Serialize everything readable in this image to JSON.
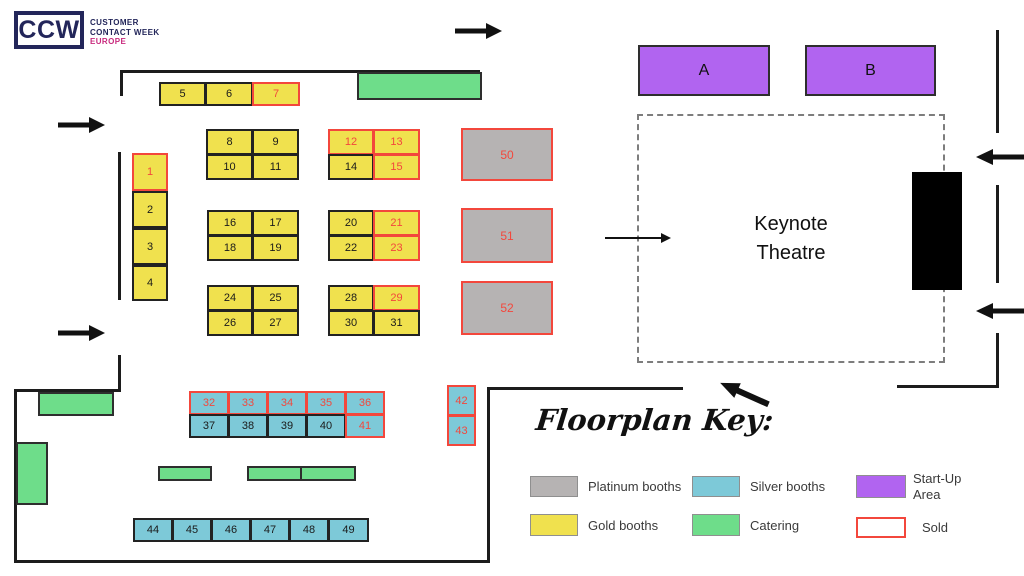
{
  "logo": {
    "mark": "CCW",
    "line1": "CUSTOMER",
    "line2": "CONTACT WEEK",
    "line3": "EUROPE"
  },
  "keynote_theatre": {
    "line1": "Keynote",
    "line2": "Theatre"
  },
  "startup_areas": {
    "a": "A",
    "b": "B"
  },
  "booths": [
    {
      "id": "1",
      "type": "gold",
      "x": 132,
      "y": 153,
      "w": 36,
      "h": 38,
      "sold": true
    },
    {
      "id": "2",
      "type": "gold",
      "x": 132,
      "y": 191,
      "w": 36,
      "h": 37,
      "sold": false
    },
    {
      "id": "3",
      "type": "gold",
      "x": 132,
      "y": 228,
      "w": 36,
      "h": 37,
      "sold": false
    },
    {
      "id": "4",
      "type": "gold",
      "x": 132,
      "y": 265,
      "w": 36,
      "h": 36,
      "sold": false
    },
    {
      "id": "5",
      "type": "gold",
      "x": 159,
      "y": 82,
      "w": 47,
      "h": 24,
      "sold": false
    },
    {
      "id": "6",
      "type": "gold",
      "x": 205,
      "y": 82,
      "w": 48,
      "h": 24,
      "sold": false
    },
    {
      "id": "7",
      "type": "gold",
      "x": 252,
      "y": 82,
      "w": 48,
      "h": 24,
      "sold": true
    },
    {
      "id": "8",
      "type": "gold",
      "x": 206,
      "y": 129,
      "w": 47,
      "h": 26,
      "sold": false
    },
    {
      "id": "9",
      "type": "gold",
      "x": 252,
      "y": 129,
      "w": 47,
      "h": 26,
      "sold": false
    },
    {
      "id": "10",
      "type": "gold",
      "x": 206,
      "y": 154,
      "w": 47,
      "h": 26,
      "sold": false
    },
    {
      "id": "11",
      "type": "gold",
      "x": 252,
      "y": 154,
      "w": 47,
      "h": 26,
      "sold": false
    },
    {
      "id": "12",
      "type": "gold",
      "x": 328,
      "y": 129,
      "w": 46,
      "h": 26,
      "sold": true
    },
    {
      "id": "13",
      "type": "gold",
      "x": 373,
      "y": 129,
      "w": 47,
      "h": 26,
      "sold": true
    },
    {
      "id": "14",
      "type": "gold",
      "x": 328,
      "y": 154,
      "w": 46,
      "h": 26,
      "sold": false
    },
    {
      "id": "15",
      "type": "gold",
      "x": 373,
      "y": 154,
      "w": 47,
      "h": 26,
      "sold": true
    },
    {
      "id": "16",
      "type": "gold",
      "x": 207,
      "y": 210,
      "w": 46,
      "h": 26,
      "sold": false
    },
    {
      "id": "17",
      "type": "gold",
      "x": 252,
      "y": 210,
      "w": 47,
      "h": 26,
      "sold": false
    },
    {
      "id": "18",
      "type": "gold",
      "x": 207,
      "y": 235,
      "w": 46,
      "h": 26,
      "sold": false
    },
    {
      "id": "19",
      "type": "gold",
      "x": 252,
      "y": 235,
      "w": 47,
      "h": 26,
      "sold": false
    },
    {
      "id": "20",
      "type": "gold",
      "x": 328,
      "y": 210,
      "w": 46,
      "h": 26,
      "sold": false
    },
    {
      "id": "21",
      "type": "gold",
      "x": 373,
      "y": 210,
      "w": 47,
      "h": 26,
      "sold": true
    },
    {
      "id": "22",
      "type": "gold",
      "x": 328,
      "y": 235,
      "w": 46,
      "h": 26,
      "sold": false
    },
    {
      "id": "23",
      "type": "gold",
      "x": 373,
      "y": 235,
      "w": 47,
      "h": 26,
      "sold": true
    },
    {
      "id": "24",
      "type": "gold",
      "x": 207,
      "y": 285,
      "w": 46,
      "h": 26,
      "sold": false
    },
    {
      "id": "25",
      "type": "gold",
      "x": 252,
      "y": 285,
      "w": 47,
      "h": 26,
      "sold": false
    },
    {
      "id": "26",
      "type": "gold",
      "x": 207,
      "y": 310,
      "w": 46,
      "h": 26,
      "sold": false
    },
    {
      "id": "27",
      "type": "gold",
      "x": 252,
      "y": 310,
      "w": 47,
      "h": 26,
      "sold": false
    },
    {
      "id": "28",
      "type": "gold",
      "x": 328,
      "y": 285,
      "w": 46,
      "h": 26,
      "sold": false
    },
    {
      "id": "29",
      "type": "gold",
      "x": 373,
      "y": 285,
      "w": 47,
      "h": 26,
      "sold": true
    },
    {
      "id": "30",
      "type": "gold",
      "x": 328,
      "y": 310,
      "w": 46,
      "h": 26,
      "sold": false
    },
    {
      "id": "31",
      "type": "gold",
      "x": 373,
      "y": 310,
      "w": 47,
      "h": 26,
      "sold": false
    },
    {
      "id": "50",
      "type": "platinum",
      "x": 461,
      "y": 128,
      "w": 92,
      "h": 53,
      "sold": true
    },
    {
      "id": "51",
      "type": "platinum",
      "x": 461,
      "y": 208,
      "w": 92,
      "h": 55,
      "sold": true
    },
    {
      "id": "52",
      "type": "platinum",
      "x": 461,
      "y": 281,
      "w": 92,
      "h": 54,
      "sold": true
    },
    {
      "id": "32",
      "type": "silver",
      "x": 189,
      "y": 391,
      "w": 40,
      "h": 24,
      "sold": true
    },
    {
      "id": "33",
      "type": "silver",
      "x": 228,
      "y": 391,
      "w": 40,
      "h": 24,
      "sold": true
    },
    {
      "id": "34",
      "type": "silver",
      "x": 267,
      "y": 391,
      "w": 40,
      "h": 24,
      "sold": true
    },
    {
      "id": "35",
      "type": "silver",
      "x": 306,
      "y": 391,
      "w": 40,
      "h": 24,
      "sold": true
    },
    {
      "id": "36",
      "type": "silver",
      "x": 345,
      "y": 391,
      "w": 40,
      "h": 24,
      "sold": true
    },
    {
      "id": "37",
      "type": "silver",
      "x": 189,
      "y": 414,
      "w": 40,
      "h": 24,
      "sold": false
    },
    {
      "id": "38",
      "type": "silver",
      "x": 228,
      "y": 414,
      "w": 40,
      "h": 24,
      "sold": false
    },
    {
      "id": "39",
      "type": "silver",
      "x": 267,
      "y": 414,
      "w": 40,
      "h": 24,
      "sold": false
    },
    {
      "id": "40",
      "type": "silver",
      "x": 306,
      "y": 414,
      "w": 40,
      "h": 24,
      "sold": false
    },
    {
      "id": "41",
      "type": "silver",
      "x": 345,
      "y": 414,
      "w": 40,
      "h": 24,
      "sold": true
    },
    {
      "id": "42",
      "type": "silver",
      "x": 447,
      "y": 385,
      "w": 29,
      "h": 31,
      "sold": true
    },
    {
      "id": "43",
      "type": "silver",
      "x": 447,
      "y": 415,
      "w": 29,
      "h": 31,
      "sold": true
    },
    {
      "id": "44",
      "type": "silver",
      "x": 133,
      "y": 518,
      "w": 40,
      "h": 24,
      "sold": false
    },
    {
      "id": "45",
      "type": "silver",
      "x": 172,
      "y": 518,
      "w": 40,
      "h": 24,
      "sold": false
    },
    {
      "id": "46",
      "type": "silver",
      "x": 211,
      "y": 518,
      "w": 40,
      "h": 24,
      "sold": false
    },
    {
      "id": "47",
      "type": "silver",
      "x": 250,
      "y": 518,
      "w": 40,
      "h": 24,
      "sold": false
    },
    {
      "id": "48",
      "type": "silver",
      "x": 289,
      "y": 518,
      "w": 40,
      "h": 24,
      "sold": false
    },
    {
      "id": "49",
      "type": "silver",
      "x": 328,
      "y": 518,
      "w": 41,
      "h": 24,
      "sold": false
    }
  ],
  "catering_areas": [
    {
      "x": 357,
      "y": 72,
      "w": 125,
      "h": 28
    },
    {
      "x": 38,
      "y": 392,
      "w": 76,
      "h": 24
    },
    {
      "x": 16,
      "y": 442,
      "w": 32,
      "h": 63
    },
    {
      "x": 158,
      "y": 466,
      "w": 54,
      "h": 15
    },
    {
      "x": 247,
      "y": 466,
      "w": 55,
      "h": 15
    },
    {
      "x": 300,
      "y": 466,
      "w": 56,
      "h": 15
    }
  ],
  "floorplan_key": {
    "title": "Floorplan Key:",
    "items": [
      {
        "label": "Platinum booths",
        "color": "#b6b3b3"
      },
      {
        "label": "Silver booths",
        "color": "#7dc9d8"
      },
      {
        "label": "Start-Up Area",
        "color": "#b164f0"
      },
      {
        "label": "Gold booths",
        "color": "#f0e14e"
      },
      {
        "label": "Catering",
        "color": "#6edd8a"
      },
      {
        "label": "Sold",
        "color": "#ffffff",
        "border": "#f3473c"
      }
    ]
  },
  "colors": {
    "gold": "#f0e14e",
    "silver": "#7dc9d8",
    "platinum": "#b6b3b3",
    "catering": "#6edd8a",
    "startup": "#b164f0",
    "sold": "#f3473c",
    "navy": "#23265a",
    "magenta": "#c8297d"
  }
}
